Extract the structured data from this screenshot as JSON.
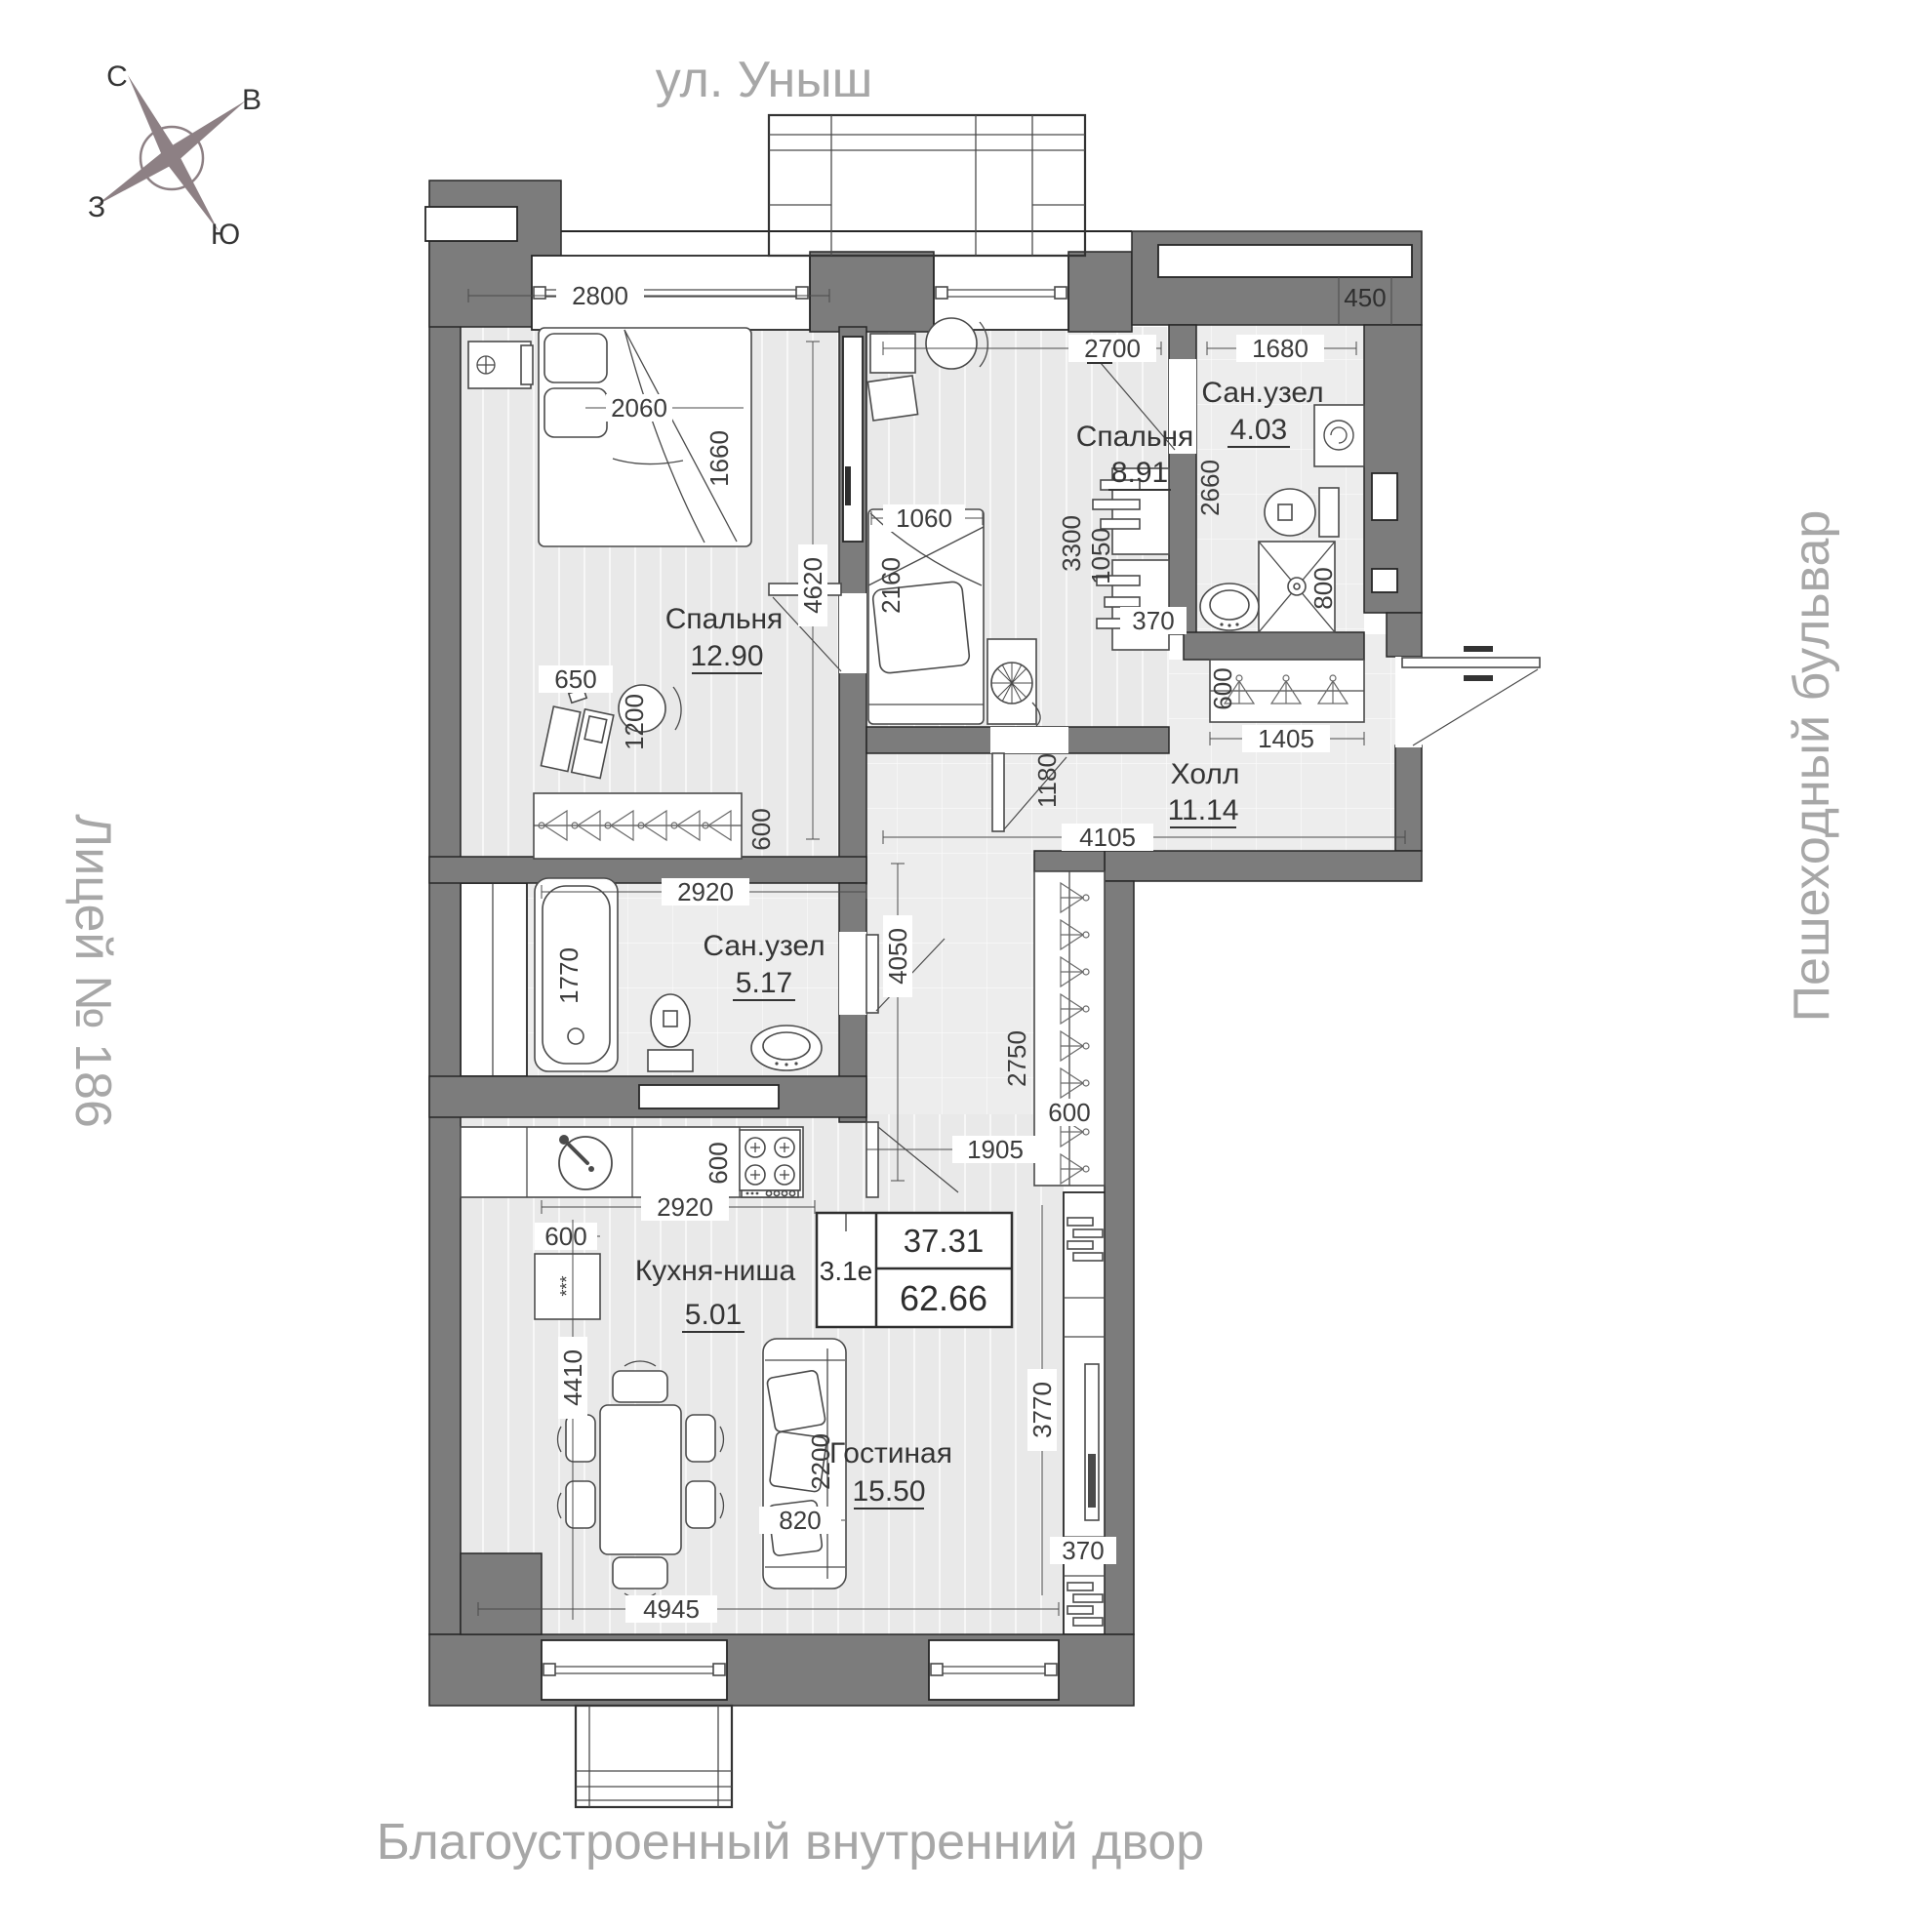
{
  "surroundings": {
    "top": "ул. Уныш",
    "right": "Пешеходный бульвар",
    "left": "Лицей № 186",
    "bottom": "Благоустроенный внутренний двор"
  },
  "compass": {
    "north": "С",
    "east": "В",
    "west": "З",
    "south": "Ю"
  },
  "unit_card": {
    "unit_id": "3.1е",
    "living_area": "37.31",
    "total_area": "62.66"
  },
  "rooms": [
    {
      "name": "Спальня",
      "area": "12.90"
    },
    {
      "name": "Спальня",
      "area": "8.91"
    },
    {
      "name": "Сан.узел",
      "area": "4.03"
    },
    {
      "name": "Холл",
      "area": "11.14"
    },
    {
      "name": "Сан.узел",
      "area": "5.17"
    },
    {
      "name": "Кухня-ниша",
      "area": "5.01"
    },
    {
      "name": "Гостиная",
      "area": "15.50"
    }
  ],
  "dimensions_mm": {
    "bedroom1_width": "2800",
    "bed1_width": "2060",
    "bed1_length": "1660",
    "bedroom1_depth": "4620",
    "desk1_width": "650",
    "chair1_zone": "1200",
    "wardrobe1_depth": "600",
    "bedroom2_width": "2700",
    "bed2_width": "1060",
    "bed2_length": "2160",
    "bedroom2_depth": "3300",
    "dresser2_length": "1050",
    "dresser2_depth": "370",
    "bath2_width": "1680",
    "duct_width": "450",
    "bath2_depth": "2660",
    "shower_width": "800",
    "hall_closet_depth": "600",
    "hall_width": "1405",
    "hall_passage": "1180",
    "hall_length": "4105",
    "bath1_width": "2920",
    "bathtub_length": "1770",
    "corridor_length": "4050",
    "corridor_closet_length": "2750",
    "corridor_closet_depth": "600",
    "corridor_width": "1905",
    "kitchen_width": "2920",
    "fridge_width": "600",
    "counter_depth": "600",
    "living_depth": "4410",
    "sofa_length": "2200",
    "sofa_depth": "820",
    "living_right_depth": "3770",
    "tv_niche_depth": "370",
    "living_width": "4945",
    "fridge_marks": "***"
  },
  "colors": {
    "wall": "#7c7c7c",
    "wall_outline": "#262626",
    "floor": "#e9e9e9",
    "tile": "#ededed",
    "label_text": "#3c3c3c",
    "peripheral_text": "#a7a7a7",
    "compass": "#8d8084"
  }
}
